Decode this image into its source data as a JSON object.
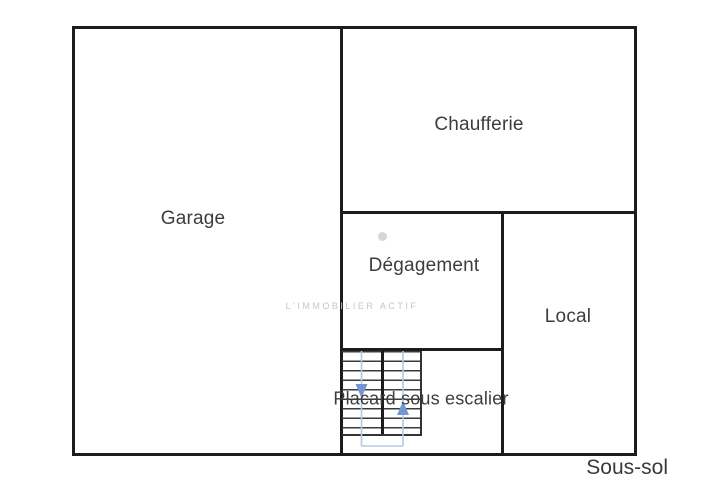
{
  "plan": {
    "floor_label": "Sous-sol",
    "watermark_text": "L'IMMOBILIER ACTIF",
    "rooms": [
      {
        "id": "garage",
        "label": "Garage"
      },
      {
        "id": "chaufferie",
        "label": "Chaufferie"
      },
      {
        "id": "degagement",
        "label": "Dégagement"
      },
      {
        "id": "local",
        "label": "Local"
      },
      {
        "id": "placard-sous-escalier",
        "label": "Placard sous escalier"
      }
    ],
    "stairs": {
      "direction_arrows": [
        "down",
        "up"
      ]
    },
    "colors": {
      "wall": "#1c1c1c",
      "label_text": "#3d3d3d",
      "stair_tread": "#3b3b3b",
      "arrow_blue": "#7496d2",
      "guide_blue": "#b5c8e8",
      "watermark_gray": "#c6c6c6",
      "dot_gray": "#d5d5de",
      "background": "#ffffff"
    }
  }
}
